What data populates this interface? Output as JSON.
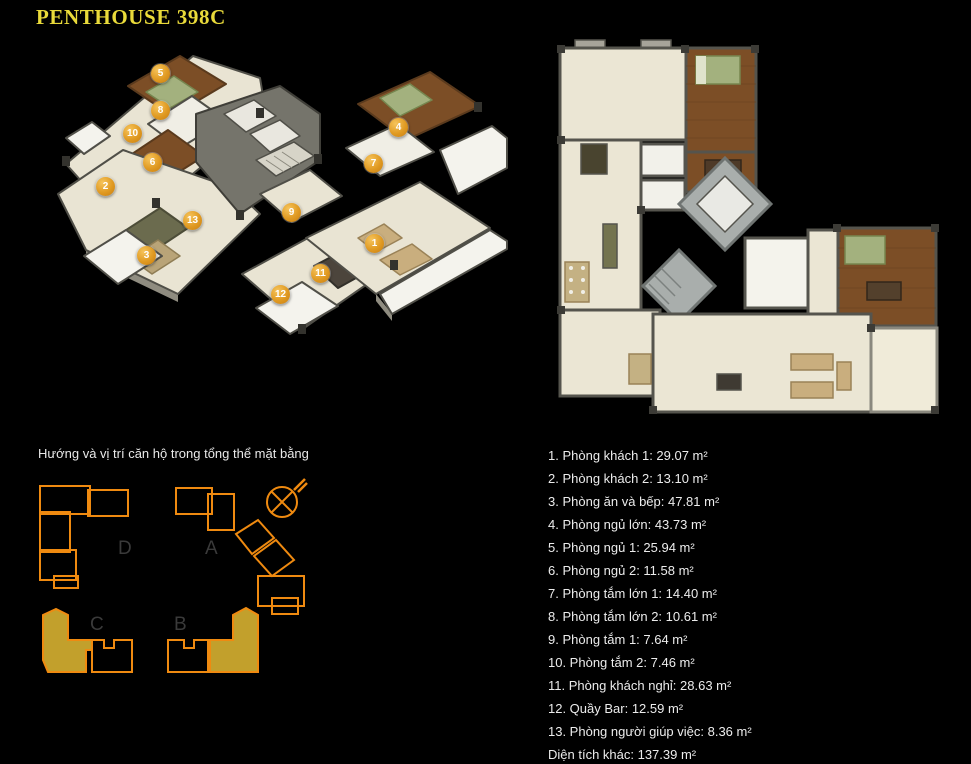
{
  "page": {
    "title": "PENTHOUSE 398C"
  },
  "colors": {
    "background": "#000000",
    "title_yellow": "#e9da3a",
    "body_text": "#ececec",
    "badge_gold": "#e09a22",
    "site_outline_orange": "#ef8a10",
    "site_fill_gold": "#c2a02c",
    "block_label_gray": "#3a3a3a",
    "floor_cream": "#e9e4d3",
    "wall_gray": "#55544d",
    "wood_brown": "#7c4e26",
    "bed_green": "#a3b17e"
  },
  "plans": {
    "plan3d_name": "isometric cutaway floor plan with numbered rooms",
    "plan2d_name": "top-down architectural floor plan"
  },
  "badges": [
    "1",
    "2",
    "3",
    "4",
    "5",
    "6",
    "7",
    "8",
    "9",
    "10",
    "11",
    "12",
    "13"
  ],
  "site_plan": {
    "caption": "Hướng và vị trí căn hộ trong tổng thể mặt bằng",
    "block_labels": [
      "D",
      "A",
      "C",
      "B"
    ],
    "compass": "compass-icon"
  },
  "room_list": [
    "1. Phòng khách 1: 29.07 m²",
    "2. Phòng khách 2: 13.10 m²",
    "3. Phòng ăn và bếp: 47.81 m²",
    "4. Phòng ngủ lớn: 43.73 m²",
    "5. Phòng ngủ 1: 25.94 m²",
    "6. Phòng ngủ 2: 11.58 m²",
    "7. Phòng tắm lớn 1: 14.40 m²",
    "8. Phòng tắm lớn 2: 10.61 m²",
    "9. Phòng tắm 1: 7.64 m²",
    "10. Phòng tắm 2: 7.46 m²",
    "11. Phòng khách nghỉ: 28.63 m²",
    "12. Quầy Bar: 12.59 m²",
    "13. Phòng người giúp việc: 8.36 m²",
    "Diện tích khác: 137.39 m²"
  ]
}
